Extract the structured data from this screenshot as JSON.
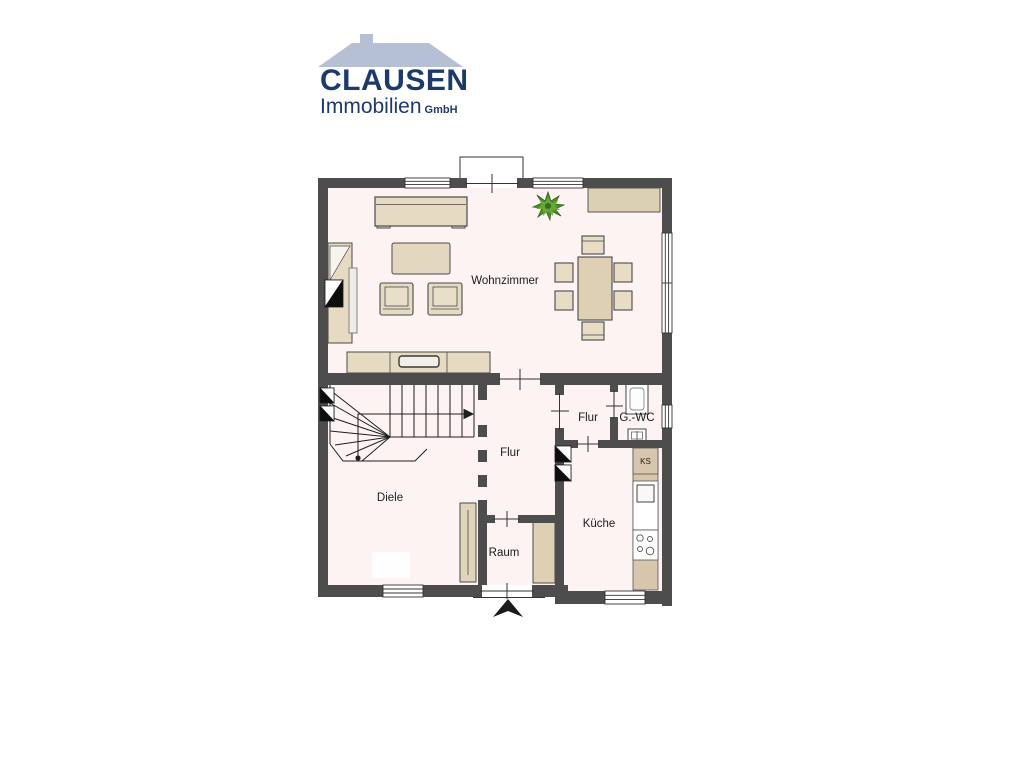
{
  "logo": {
    "company": "CLAUSEN",
    "subtitle": "Immobilien",
    "suffix": "GmbH",
    "navy_color": "#1d3a6d",
    "roof_color": "#b6c0d4"
  },
  "floorplan": {
    "colors": {
      "wall": "#4d4d4e",
      "floor": "#fdf3f3",
      "furniture": "#e6dbc2",
      "furniture_dark": "#dbcfb4",
      "kitchen_counter": "#d7c6ab",
      "plant_green": "#4e8f2a",
      "outline": "#4a4a4a"
    },
    "rooms": {
      "living": {
        "label": "Wohnzimmer"
      },
      "hall": {
        "label": "Diele"
      },
      "corridor": {
        "label": "Flur"
      },
      "corridor_small": {
        "label": "Flur"
      },
      "guest_wc": {
        "label": "G.-WC"
      },
      "room": {
        "label": "Raum"
      },
      "kitchen": {
        "label": "Küche",
        "fridge": "KS"
      }
    }
  }
}
